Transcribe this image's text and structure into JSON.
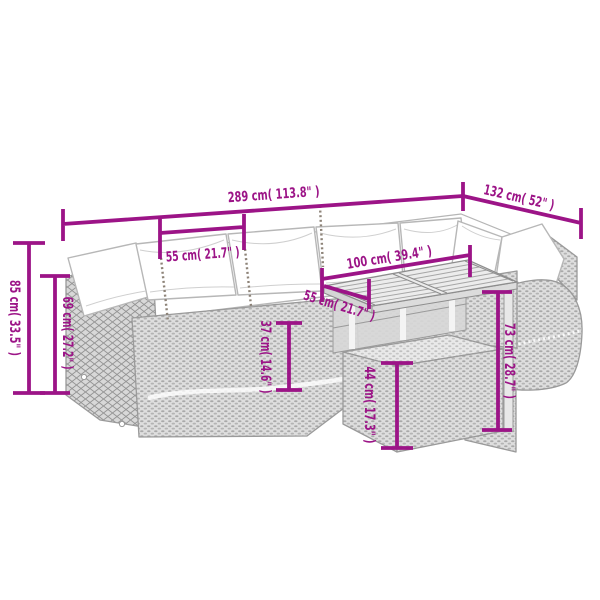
{
  "diagram": {
    "type": "product-dimension-diagram",
    "subject": "rattan garden lounge set: corner sofa with cushions, slatted-top table, ottoman",
    "colors": {
      "dimension_lines": "#9c1487",
      "furniture_lines": "#9a9a9a",
      "background": "#ffffff"
    },
    "dimensions": {
      "total_length": "289 cm( 113.8\" )",
      "right_section_depth": "132 cm( 52\" )",
      "total_height": "85 cm( 33.5\" )",
      "backrest_height": "69 cm( 27.2\" )",
      "seat_width": "55 cm( 21.7\" )",
      "table_length": "100 cm( 39.4\" )",
      "table_depth": "55 cm( 21.7\" )",
      "seat_height": "37 cm( 14.6\" )",
      "ottoman_height": "44 cm( 17.3\" )",
      "table_height": "73 cm( 28.7\" )"
    }
  }
}
